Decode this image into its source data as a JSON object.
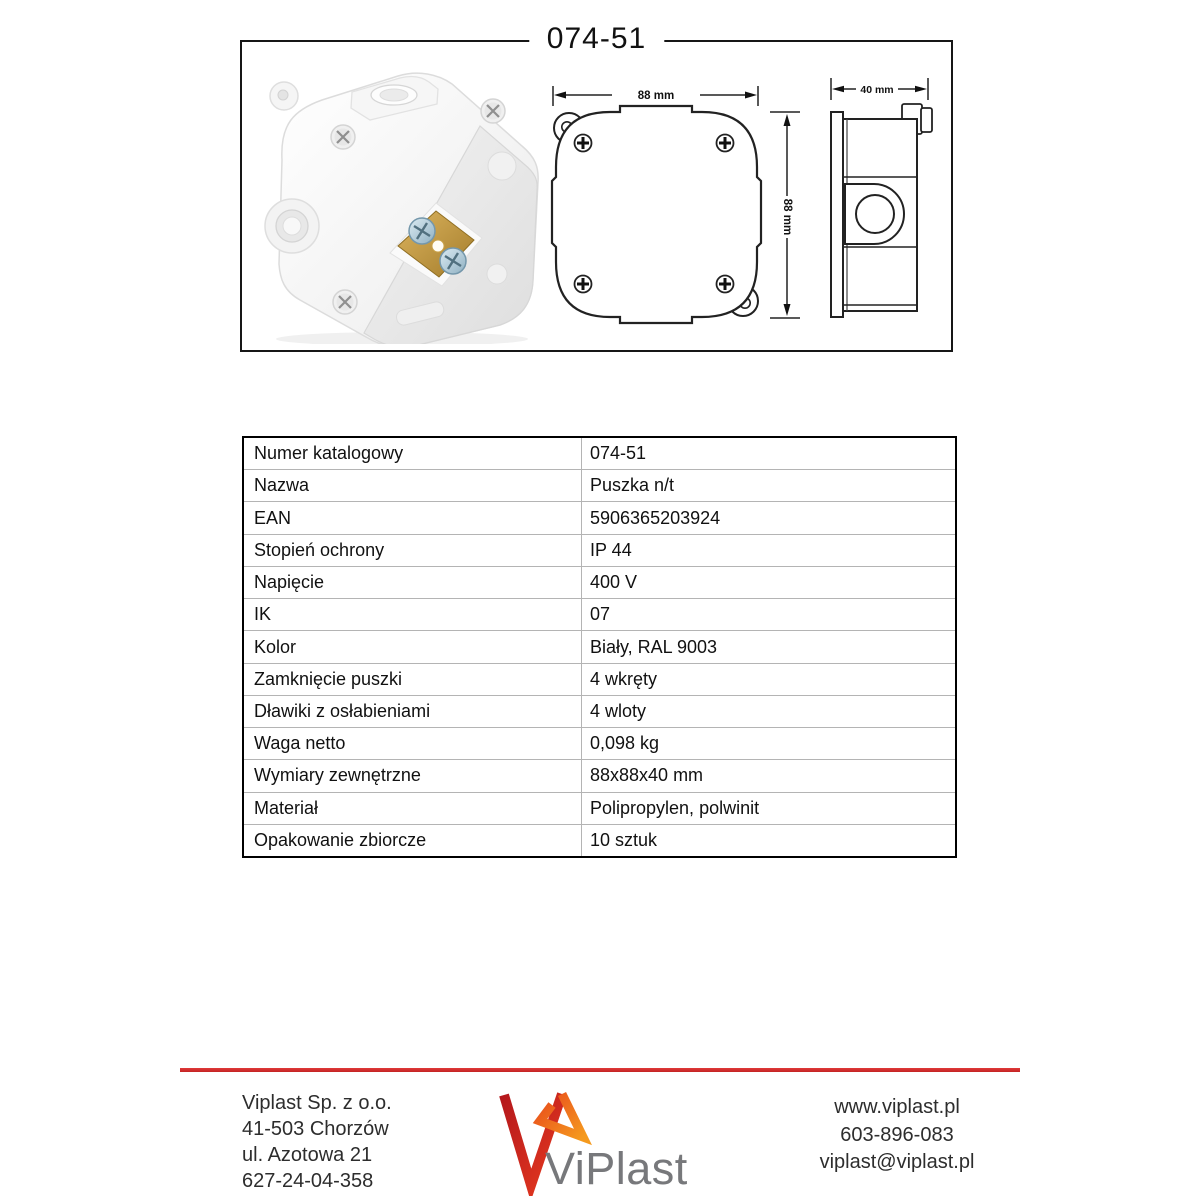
{
  "document": {
    "title": "074-51"
  },
  "drawings": {
    "front": {
      "width_label": "88 mm",
      "height_label": "88 mm"
    },
    "side": {
      "depth_label": "40 mm"
    }
  },
  "spec_table": {
    "rows": [
      {
        "label": "Numer katalogowy",
        "value": "074-51"
      },
      {
        "label": "Nazwa",
        "value": "Puszka n/t"
      },
      {
        "label": "EAN",
        "value": "5906365203924"
      },
      {
        "label": "Stopień ochrony",
        "value": "IP 44"
      },
      {
        "label": "Napięcie",
        "value": "400 V"
      },
      {
        "label": "IK",
        "value": "07"
      },
      {
        "label": "Kolor",
        "value": "Biały, RAL 9003"
      },
      {
        "label": "Zamknięcie puszki",
        "value": "4 wkręty"
      },
      {
        "label": "Dławiki z osłabieniami",
        "value": "4 wloty"
      },
      {
        "label": "Waga netto",
        "value": "0,098 kg"
      },
      {
        "label": "Wymiary zewnętrzne",
        "value": "88x88x40 mm"
      },
      {
        "label": "Materiał",
        "value": "Polipropylen, polwinit"
      },
      {
        "label": "Opakowanie zbiorcze",
        "value": "10 sztuk"
      }
    ]
  },
  "footer": {
    "company": {
      "lines": [
        "Viplast Sp. z o.o.",
        "41-503 Chorzów",
        "ul. Azotowa 21",
        "627-24-04-358"
      ]
    },
    "logo": {
      "text": "ViPlast",
      "mark_red": "#c21b1e",
      "mark_orange": "#f07a1e",
      "text_color": "#77787b"
    },
    "contact": {
      "website": "www.viplast.pl",
      "phone": "603-896-083",
      "email": "viplast@viplast.pl"
    },
    "accent_line_color": "#c32323"
  }
}
